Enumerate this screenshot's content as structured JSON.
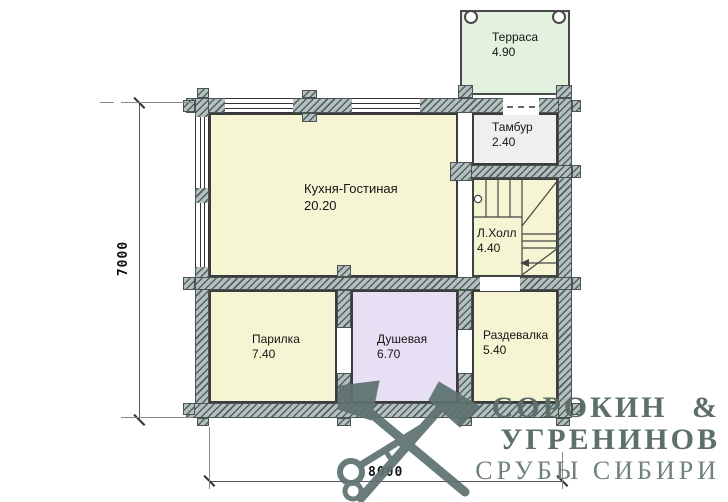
{
  "plan": {
    "rooms": {
      "terrace": {
        "name": "Терраса",
        "area": "4.90"
      },
      "tambour": {
        "name": "Тамбур",
        "area": "2.40"
      },
      "kitchen": {
        "name": "Кухня-Гостиная",
        "area": "20.20"
      },
      "hall": {
        "name": "Л.Холл",
        "area": "4.40"
      },
      "parilka": {
        "name": "Парилка",
        "area": "7.40"
      },
      "shower": {
        "name": "Душевая",
        "area": "6.70"
      },
      "dressing": {
        "name": "Раздевалка",
        "area": "5.40"
      }
    },
    "dimensions": {
      "vertical": "7000",
      "horizontal": "8000"
    }
  },
  "branding": {
    "line1": "СОРОКИН &",
    "line2": "УГРЕНИНОВ",
    "line3": "СРУБЫ СИБИРИ"
  },
  "colors": {
    "room_yellow": "#f5f4d3",
    "terrace_green": "#e3f2de",
    "shower_purple": "#e7e0f4",
    "tambour_gray": "#efefef",
    "wall_hatch": "#b4c0bf",
    "logo": "#5e7270"
  }
}
